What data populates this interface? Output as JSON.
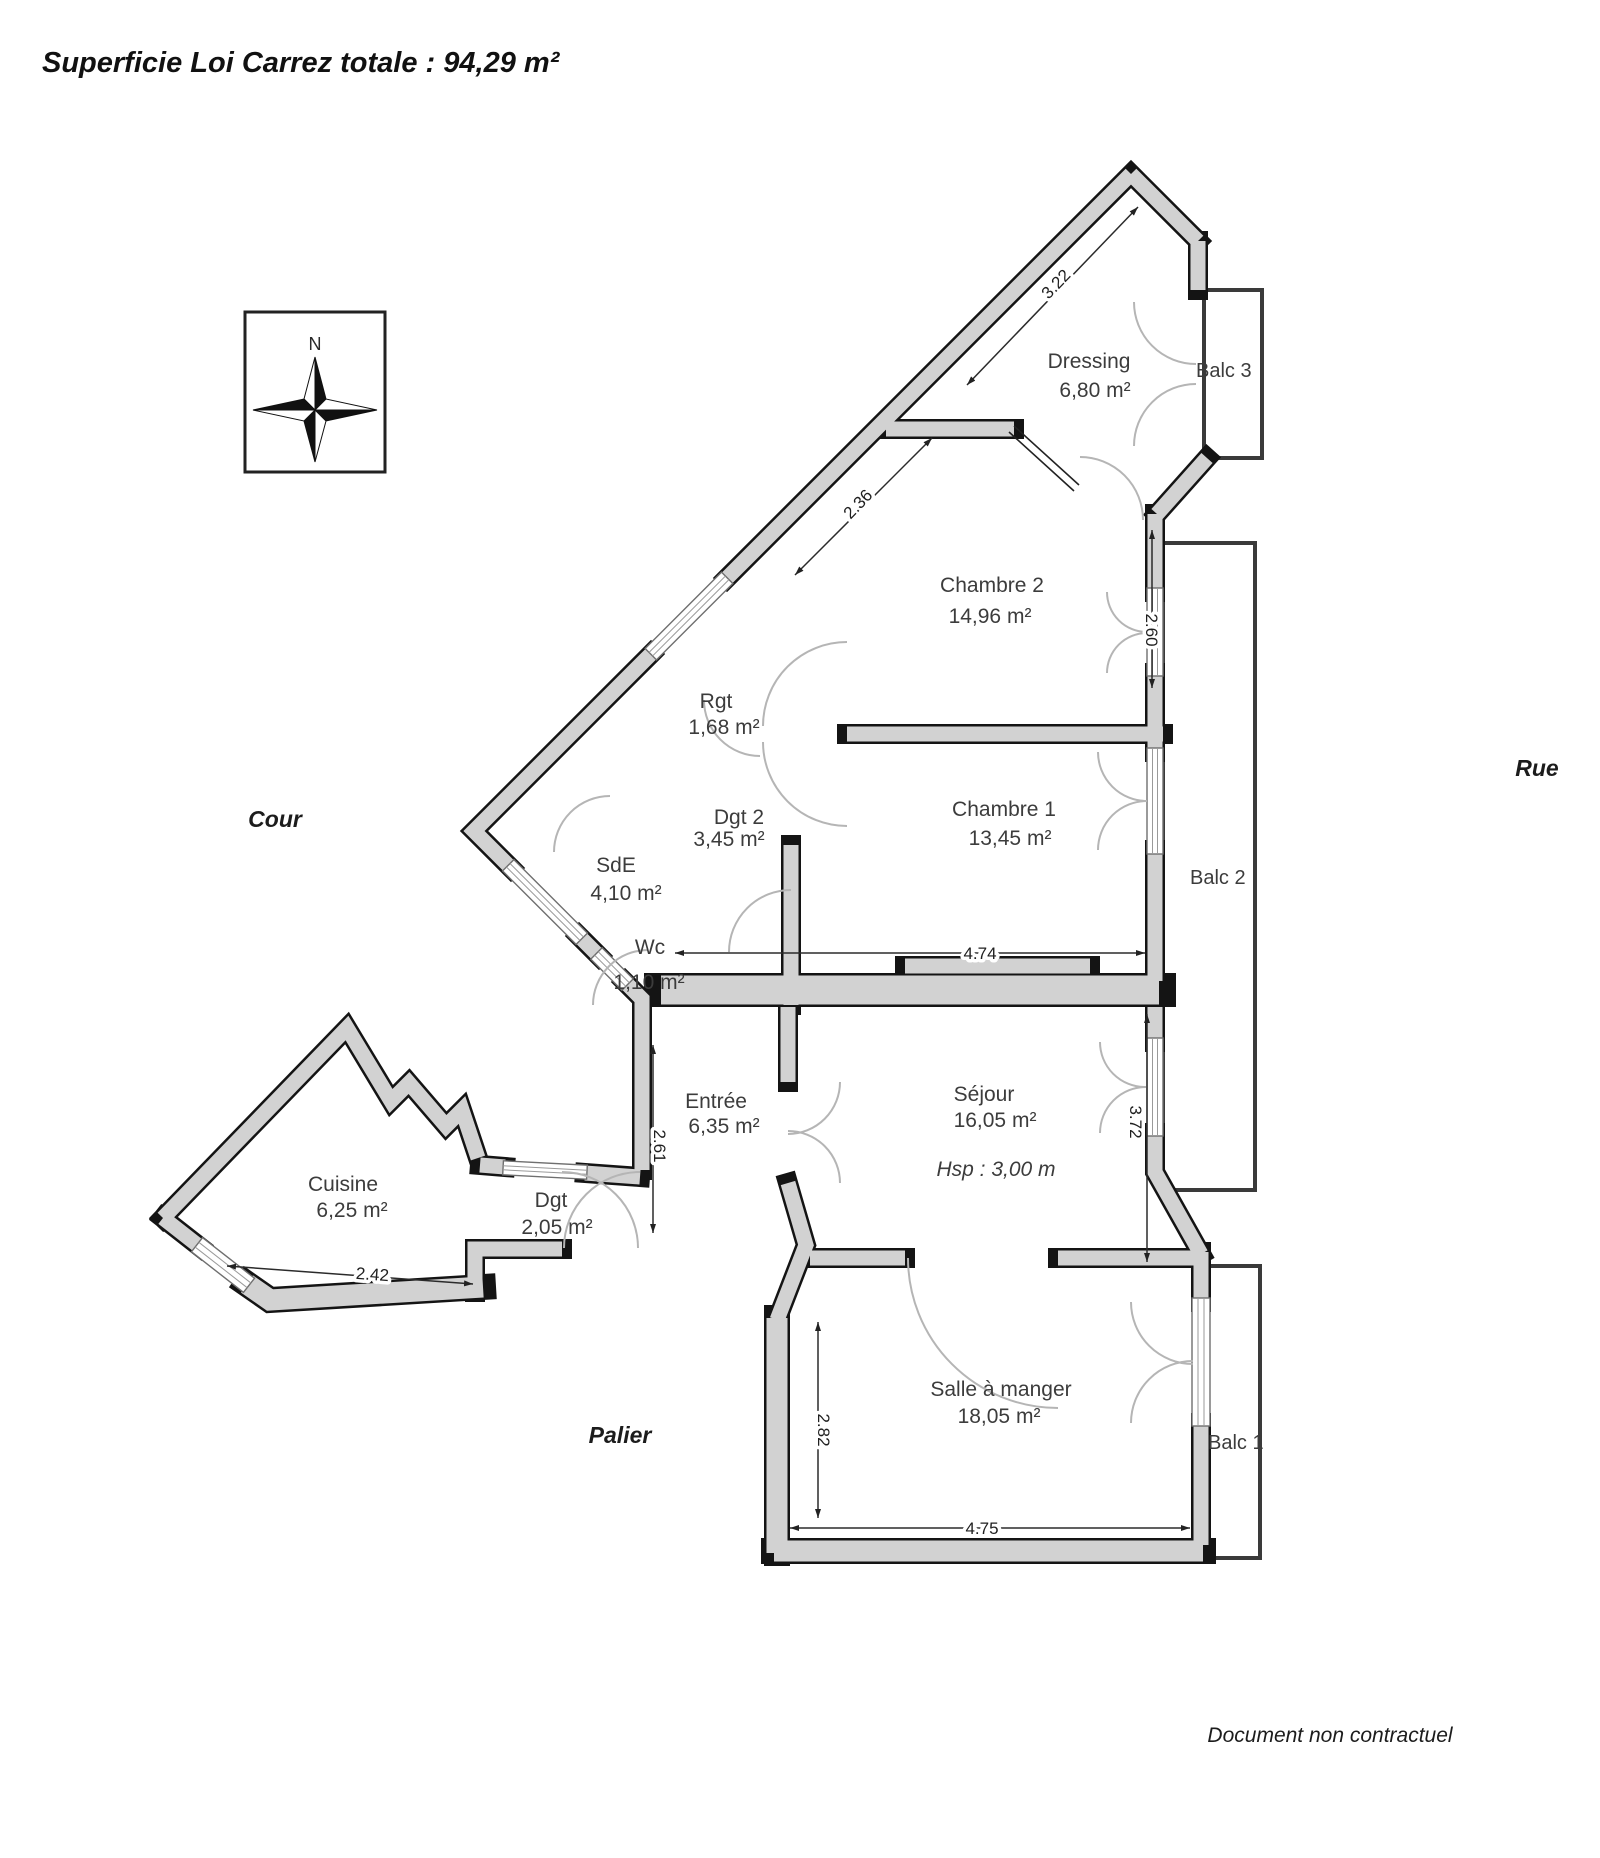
{
  "title": "Superficie Loi Carrez totale : 94,29 m²",
  "footer": "Document non contractuel",
  "compass": {
    "north": "N"
  },
  "context": {
    "cour": "Cour",
    "rue": "Rue",
    "palier": "Palier"
  },
  "rooms": {
    "dressing": {
      "name": "Dressing",
      "area": "6,80 m²"
    },
    "chambre2": {
      "name": "Chambre 2",
      "area": "14,96 m²"
    },
    "rgt": {
      "name": "Rgt",
      "area": "1,68 m²"
    },
    "dgt2": {
      "name": "Dgt 2",
      "area": "3,45 m²"
    },
    "chambre1": {
      "name": "Chambre 1",
      "area": "13,45 m²"
    },
    "sde": {
      "name": "SdE",
      "area": "4,10 m²"
    },
    "wc": {
      "name": "Wc",
      "area": "1,10 m²"
    },
    "entree": {
      "name": "Entrée",
      "area": "6,35 m²"
    },
    "sejour": {
      "name": "Séjour",
      "area": "16,05 m²",
      "note": "Hsp : 3,00 m"
    },
    "cuisine": {
      "name": "Cuisine",
      "area": "6,25 m²"
    },
    "dgt": {
      "name": "Dgt",
      "area": "2,05 m²"
    },
    "salle_a_manger": {
      "name": "Salle à manger",
      "area": "18,05 m²"
    }
  },
  "balconies": {
    "balc1": {
      "name": "Balc 1"
    },
    "balc2": {
      "name": "Balc 2"
    },
    "balc3": {
      "name": "Balc 3"
    }
  },
  "dimensions": {
    "d1": "3.22",
    "d2": "2.36",
    "d3": "2.60",
    "d4": "4.74",
    "d5": "3.72",
    "d6": "2.61",
    "d7": "2.82",
    "d8": "2.42",
    "d9": "4.75"
  },
  "colors": {
    "wall_fill": "#d2d2d2",
    "wall_edge": "#141414",
    "door_arc": "#b5b5b5"
  }
}
